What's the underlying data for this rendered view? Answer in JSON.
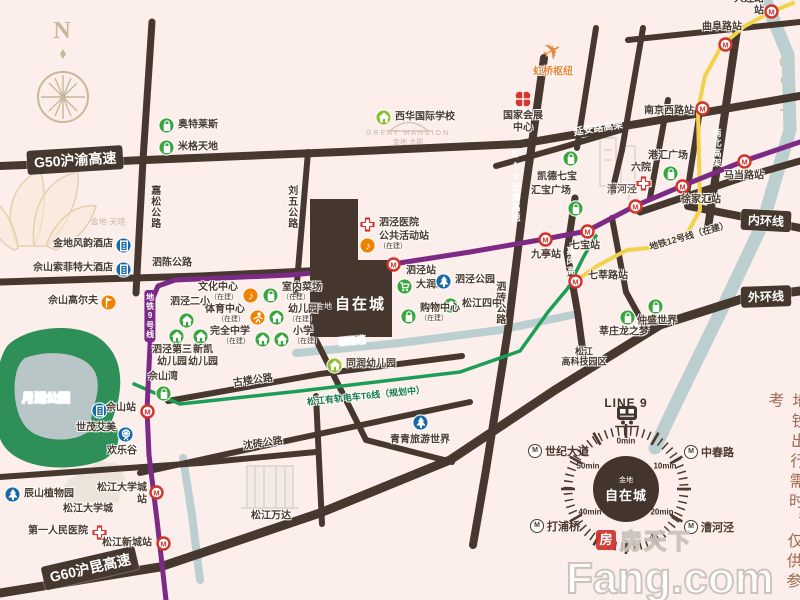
{
  "compass": {
    "letter": "N"
  },
  "colors": {
    "bg": "#fceeea",
    "road": "#46382f",
    "line9": "#7c2a85",
    "line12": "#f2d24b",
    "tram": "#1d9e57",
    "water": "#bccfd0",
    "park": "#2e9058",
    "lake": "#b9c6c8",
    "metro_red": "#d0342c",
    "poi_green": "#3aa43f",
    "poi_lime": "#8cbf2f",
    "poi_blue": "#1668a8",
    "poi_orange": "#ef8200",
    "hospital_red": "#d7342c"
  },
  "icons": {
    "metro_glyph": "M"
  },
  "project": {
    "brand": "金地",
    "name": "自在城"
  },
  "road_banners": [
    {
      "text": "G50沪渝高速",
      "x": 27,
      "y": 148,
      "rot": -3.5,
      "fs": 14
    },
    {
      "text": "G60沪昆高速",
      "x": 42,
      "y": 556,
      "rot": -13,
      "fs": 14
    },
    {
      "text": "内环线",
      "x": 741,
      "y": 210,
      "rot": 3,
      "fs": 12
    },
    {
      "text": "外环线",
      "x": 741,
      "y": 286,
      "rot": -2,
      "fs": 12
    }
  ],
  "onroad_labels": [
    {
      "text": "延安路高架",
      "x": 598,
      "y": 127,
      "rot": -9,
      "fs": 10
    },
    {
      "text": "G15沈海高速",
      "x": 516,
      "y": 186,
      "vertical": true,
      "fs": 9
    },
    {
      "text": "南北高架",
      "x": 717,
      "y": 148,
      "vertical": true,
      "fs": 9
    },
    {
      "text": "嘉闵高架",
      "x": 571,
      "y": 266,
      "vertical": true,
      "fs": 9
    }
  ],
  "street_labels": [
    {
      "text": "嘉松公路",
      "x": 154,
      "y": 207,
      "vertical": true,
      "fs": 10
    },
    {
      "text": "刘五公路",
      "x": 291,
      "y": 207,
      "vertical": true,
      "fs": 10
    },
    {
      "text": "泗陈公路",
      "x": 172,
      "y": 263,
      "fs": 10
    },
    {
      "text": "泗砖公路",
      "x": 499,
      "y": 303,
      "vertical": true,
      "fs": 10
    },
    {
      "text": "古楼公路",
      "x": 253,
      "y": 381,
      "rot": -8,
      "fs": 10
    },
    {
      "text": "沈砖公路",
      "x": 263,
      "y": 444,
      "rot": -8,
      "fs": 10
    }
  ],
  "area_labels": [
    {
      "text": "漕河泾",
      "x": 622,
      "y": 190,
      "fs": 10,
      "color": "#6b584a"
    },
    {
      "text": "松江\n高科技园区",
      "x": 584,
      "y": 357,
      "fs": 9
    },
    {
      "text": "松江大学城",
      "x": 88,
      "y": 509,
      "fs": 10
    },
    {
      "text": "松江万达",
      "x": 271,
      "y": 516,
      "fs": 10
    }
  ],
  "watermark_labels": [
    {
      "text": "金地·天境",
      "x": 108,
      "y": 222,
      "fs": 8
    },
    {
      "text": "GREAT MANSION",
      "x": 408,
      "y": 134,
      "fs": 7,
      "ls": 2
    },
    {
      "text": "金地·大郡",
      "x": 408,
      "y": 143,
      "fs": 7
    }
  ],
  "roads": [
    {
      "name": "G50-yanan-elevated",
      "pts": [
        [
          0,
          166
        ],
        [
          340,
          152
        ],
        [
          520,
          144
        ],
        [
          800,
          96
        ]
      ],
      "w": 8
    },
    {
      "name": "jiasong-rd",
      "pts": [
        [
          152,
          22
        ],
        [
          143,
          160
        ],
        [
          136,
          293
        ]
      ],
      "w": 7
    },
    {
      "name": "liuwu-rd",
      "pts": [
        [
          308,
          152
        ],
        [
          296,
          294
        ]
      ],
      "w": 6
    },
    {
      "name": "sichen-rd",
      "pts": [
        [
          0,
          282
        ],
        [
          200,
          276
        ],
        [
          350,
          269
        ]
      ],
      "w": 7
    },
    {
      "name": "g15-sizhuan-rd",
      "pts": [
        [
          544,
          58
        ],
        [
          524,
          200
        ],
        [
          508,
          330
        ],
        [
          486,
          470
        ],
        [
          473,
          545
        ]
      ],
      "w": 8
    },
    {
      "name": "jiamin-elevated",
      "pts": [
        [
          575,
          198
        ],
        [
          567,
          252
        ],
        [
          578,
          315
        ],
        [
          584,
          360
        ]
      ],
      "w": 7
    },
    {
      "name": "nanbei-elevated",
      "pts": [
        [
          737,
          30
        ],
        [
          721,
          140
        ],
        [
          708,
          228
        ]
      ],
      "w": 8
    },
    {
      "name": "inner-ring-rd",
      "pts": [
        [
          688,
          206
        ],
        [
          800,
          228
        ]
      ],
      "w": 8
    },
    {
      "name": "g60-outer-ring-rd",
      "pts": [
        [
          0,
          593
        ],
        [
          160,
          567
        ],
        [
          320,
          513
        ],
        [
          450,
          460
        ],
        [
          555,
          390
        ],
        [
          660,
          325
        ],
        [
          745,
          298
        ],
        [
          800,
          291
        ]
      ],
      "w": 9
    },
    {
      "name": "gulou-rd",
      "pts": [
        [
          168,
          401
        ],
        [
          320,
          374
        ],
        [
          462,
          356
        ]
      ],
      "w": 6
    },
    {
      "name": "shenzhuan-rd",
      "pts": [
        [
          140,
          473
        ],
        [
          300,
          438
        ],
        [
          470,
          402
        ]
      ],
      "w": 6
    },
    {
      "name": "wanda-rd",
      "pts": [
        [
          316,
          396
        ],
        [
          322,
          524
        ]
      ],
      "w": 6
    },
    {
      "name": "mid-diagonal-rd",
      "pts": [
        [
          316,
          340
        ],
        [
          366,
          440
        ],
        [
          452,
          462
        ]
      ],
      "w": 6
    },
    {
      "name": "songjiang-rd",
      "pts": [
        [
          0,
          477
        ],
        [
          200,
          463
        ],
        [
          316,
          452
        ]
      ],
      "w": 6
    },
    {
      "name": "hongqiao-rd-1",
      "pts": [
        [
          596,
          28
        ],
        [
          577,
          148
        ]
      ],
      "w": 6
    },
    {
      "name": "hongqiao-rd-2",
      "pts": [
        [
          643,
          28
        ],
        [
          622,
          150
        ],
        [
          612,
          192
        ]
      ],
      "w": 6
    },
    {
      "name": "qibao-rd",
      "pts": [
        [
          496,
          166
        ],
        [
          560,
          148
        ],
        [
          624,
          129
        ]
      ],
      "w": 6
    },
    {
      "name": "xujiahui-rd-1",
      "pts": [
        [
          668,
          100
        ],
        [
          650,
          198
        ]
      ],
      "w": 6
    },
    {
      "name": "xujiahui-rd-2",
      "pts": [
        [
          701,
          104
        ],
        [
          686,
          200
        ]
      ],
      "w": 6
    },
    {
      "name": "zhaojiabang-rd",
      "pts": [
        [
          640,
          212
        ],
        [
          744,
          177
        ],
        [
          800,
          161
        ]
      ],
      "w": 7
    },
    {
      "name": "north-bund-rd",
      "pts": [
        [
          628,
          40
        ],
        [
          800,
          22
        ]
      ],
      "w": 6
    },
    {
      "name": "xinzhuang-rd",
      "pts": [
        [
          612,
          218
        ],
        [
          626,
          292
        ],
        [
          648,
          332
        ]
      ],
      "w": 6
    }
  ],
  "transit": {
    "line9": {
      "color": "#7c2a85",
      "w": 5,
      "label": "地铁9号线",
      "label_x": 150,
      "label_y": 316,
      "path": [
        [
          166,
          600
        ],
        [
          157,
          520
        ],
        [
          149,
          455
        ],
        [
          147,
          410
        ],
        [
          150,
          345
        ],
        [
          152,
          300
        ],
        [
          158,
          286
        ],
        [
          175,
          280
        ],
        [
          290,
          275
        ],
        [
          345,
          270
        ],
        [
          393,
          264
        ],
        [
          470,
          252
        ],
        [
          545,
          239
        ],
        [
          587,
          231
        ],
        [
          635,
          206
        ],
        [
          682,
          186
        ],
        [
          744,
          161
        ],
        [
          800,
          142
        ]
      ]
    },
    "line12": {
      "color": "#f2d24b",
      "w": 4,
      "label": "地铁12号线（在建）",
      "label_x": 689,
      "label_y": 236,
      "label_rot": -16,
      "path": [
        [
          793,
          3
        ],
        [
          771,
          12
        ],
        [
          745,
          26
        ],
        [
          722,
          45
        ],
        [
          705,
          76
        ],
        [
          698,
          110
        ],
        [
          699,
          160
        ],
        [
          700,
          210
        ],
        [
          688,
          232
        ],
        [
          660,
          247
        ],
        [
          627,
          250
        ],
        [
          597,
          266
        ],
        [
          577,
          280
        ]
      ]
    },
    "tram": {
      "color": "#1d9e57",
      "w": 3.5,
      "label": "松江有轨电车T6线（规划中）",
      "label_x": 366,
      "label_y": 396,
      "label_rot": -6,
      "label_color": "#14794a",
      "path": [
        [
          134,
          384
        ],
        [
          180,
          404
        ],
        [
          300,
          391
        ],
        [
          460,
          372
        ],
        [
          520,
          351
        ],
        [
          548,
          312
        ],
        [
          568,
          288
        ],
        [
          584,
          256
        ],
        [
          596,
          236
        ]
      ]
    }
  },
  "stations": [
    {
      "name": "大连路站",
      "x": 771,
      "y": 11,
      "lx": 764,
      "ly": 5,
      "a": "r"
    },
    {
      "name": "曲阜路站",
      "x": 725,
      "y": 44,
      "lx": 722,
      "ly": 27,
      "a": "c"
    },
    {
      "name": "南京西路站",
      "x": 702,
      "y": 108,
      "lx": 694,
      "ly": 111,
      "a": "r"
    },
    {
      "name": "马当路站",
      "x": 744,
      "y": 161,
      "lx": 744,
      "ly": 176,
      "a": "c"
    },
    {
      "name": "徐家汇站",
      "x": 682,
      "y": 186,
      "lx": 701,
      "ly": 200,
      "a": "c"
    },
    {
      "name": "",
      "x": 635,
      "y": 206
    },
    {
      "name": "七宝站",
      "x": 587,
      "y": 231,
      "lx": 585,
      "ly": 246,
      "a": "c"
    },
    {
      "name": "九亭站",
      "x": 545,
      "y": 239,
      "lx": 546,
      "ly": 255,
      "a": "c"
    },
    {
      "name": "泗泾站",
      "x": 393,
      "y": 264,
      "lx": 406,
      "ly": 271,
      "a": "l"
    },
    {
      "name": "佘山站",
      "x": 147,
      "y": 411,
      "lx": 136,
      "ly": 408,
      "a": "r"
    },
    {
      "name": "松江大学城站",
      "x": 156,
      "y": 492,
      "lx": 147,
      "ly": 494,
      "a": "r",
      "w": 52
    },
    {
      "name": "松江新城站",
      "x": 163,
      "y": 543,
      "lx": 152,
      "ly": 543,
      "a": "r"
    },
    {
      "name": "七莘路站",
      "x": 575,
      "y": 281,
      "lx": 588,
      "ly": 276,
      "a": "l"
    }
  ],
  "pois": [
    {
      "t": "bag",
      "c": "green",
      "x": 166,
      "y": 125,
      "label": "奥特莱斯",
      "lx": 178,
      "ly": 125,
      "a": "l"
    },
    {
      "t": "bag",
      "c": "green",
      "x": 166,
      "y": 147,
      "label": "米格天地",
      "lx": 178,
      "ly": 147,
      "a": "l"
    },
    {
      "t": "home",
      "c": "lime",
      "x": 383,
      "y": 117,
      "label": "西华国际学校",
      "lx": 395,
      "ly": 117,
      "a": "l"
    },
    {
      "t": "clover",
      "c": "red",
      "x": 523,
      "y": 99,
      "label": "国家会展\n中心",
      "lx": 523,
      "ly": 122,
      "a": "c"
    },
    {
      "t": "plane",
      "c": "orange",
      "x": 552,
      "y": 51,
      "label": "虹桥枢纽",
      "lx": 553,
      "ly": 72,
      "a": "c",
      "lc": "#e8873b"
    },
    {
      "t": "bag",
      "c": "green",
      "x": 570,
      "y": 158,
      "label": "凯德七宝",
      "lx": 557,
      "ly": 177,
      "a": "c"
    },
    {
      "t": "bag",
      "c": "green",
      "x": 575,
      "y": 208,
      "label": "汇宝广场",
      "lx": 551,
      "ly": 191,
      "a": "c"
    },
    {
      "t": "cross",
      "c": "red",
      "x": 643,
      "y": 183,
      "label": "六院",
      "lx": 641,
      "ly": 168,
      "a": "c"
    },
    {
      "t": "bag",
      "c": "green",
      "x": 670,
      "y": 173,
      "label": "港汇广场",
      "lx": 668,
      "ly": 156,
      "a": "c"
    },
    {
      "t": "cart",
      "c": "green",
      "x": 404,
      "y": 286,
      "label": "大润发",
      "lx": 416,
      "ly": 285,
      "a": "l"
    },
    {
      "t": "tree",
      "c": "blue",
      "x": 443,
      "y": 281,
      "label": "泗泾公园",
      "lx": 455,
      "ly": 280,
      "a": "l"
    },
    {
      "t": "home",
      "c": "green",
      "x": 450,
      "y": 305,
      "label": "松江四中",
      "lx": 462,
      "ly": 304,
      "a": "l"
    },
    {
      "t": "bag",
      "c": "green",
      "x": 408,
      "y": 316,
      "label": "购物中心",
      "sub": "（在建）",
      "lx": 420,
      "ly": 313,
      "a": "l"
    },
    {
      "t": "cross",
      "c": "red",
      "x": 367,
      "y": 224,
      "label": "泗泾医院",
      "lx": 379,
      "ly": 223,
      "a": "l"
    },
    {
      "t": "music",
      "c": "orange",
      "x": 367,
      "y": 245,
      "label": "公共活动站",
      "sub": "（在建）",
      "lx": 379,
      "ly": 241,
      "a": "l"
    },
    {
      "t": "music",
      "c": "orange",
      "x": 250,
      "y": 295,
      "label": "文化中心",
      "sub": "（在建）",
      "lx": 238,
      "ly": 292,
      "a": "r"
    },
    {
      "t": "bag",
      "c": "green",
      "x": 270,
      "y": 295,
      "label": "室内菜场",
      "sub": "（在建）",
      "lx": 282,
      "ly": 292,
      "a": "l"
    },
    {
      "t": "sport",
      "c": "orange",
      "x": 257,
      "y": 317,
      "label": "体育中心",
      "sub": "（在建）",
      "lx": 245,
      "ly": 314,
      "a": "r"
    },
    {
      "t": "home",
      "c": "green",
      "x": 276,
      "y": 317,
      "label": "幼儿园",
      "sub": "（在建）",
      "lx": 288,
      "ly": 314,
      "a": "l"
    },
    {
      "t": "home",
      "c": "green",
      "x": 262,
      "y": 339,
      "label": "完全中学",
      "sub": "（在建）",
      "lx": 250,
      "ly": 336,
      "a": "r"
    },
    {
      "t": "home",
      "c": "green",
      "x": 281,
      "y": 339,
      "label": "小学",
      "sub": "（在建）",
      "lx": 293,
      "ly": 336,
      "a": "l"
    },
    {
      "t": "home",
      "c": "green",
      "x": 186,
      "y": 320,
      "label": "泗泾二小",
      "lx": 190,
      "ly": 302,
      "a": "c"
    },
    {
      "t": "home",
      "c": "green",
      "x": 176,
      "y": 336,
      "label": "泗泾第三\n幼儿园",
      "lx": 172,
      "ly": 356,
      "a": "c"
    },
    {
      "t": "home",
      "c": "green",
      "x": 200,
      "y": 336,
      "label": "新凯\n幼儿园",
      "lx": 203,
      "ly": 356,
      "a": "c"
    },
    {
      "t": "bag",
      "c": "green",
      "x": 163,
      "y": 393,
      "label": "佘山湾",
      "lx": 163,
      "ly": 377,
      "a": "c"
    },
    {
      "t": "flag",
      "c": "orange",
      "x": 108,
      "y": 302,
      "label": "佘山高尔夫",
      "lx": 98,
      "ly": 301,
      "a": "r"
    },
    {
      "t": "building",
      "c": "blue",
      "x": 123,
      "y": 245,
      "label": "金地风韵酒店",
      "lx": 113,
      "ly": 244,
      "a": "r"
    },
    {
      "t": "building",
      "c": "blue",
      "x": 123,
      "y": 269,
      "label": "佘山索菲特大酒店",
      "lx": 113,
      "ly": 268,
      "a": "r"
    },
    {
      "t": "building",
      "c": "blue",
      "x": 99,
      "y": 410,
      "label": "世茂艾美",
      "lx": 96,
      "ly": 428,
      "a": "c"
    },
    {
      "t": "ferris",
      "c": "blue",
      "x": 125,
      "y": 434,
      "label": "欢乐谷",
      "lx": 122,
      "ly": 451,
      "a": "c"
    },
    {
      "t": "tree",
      "c": "blue",
      "x": 12,
      "y": 494,
      "label": "辰山植物园",
      "lx": 24,
      "ly": 494,
      "a": "l"
    },
    {
      "t": "cross",
      "c": "red",
      "x": 99,
      "y": 532,
      "label": "第一人民医院",
      "lx": 88,
      "ly": 531,
      "a": "r"
    },
    {
      "t": "home",
      "c": "lime",
      "x": 334,
      "y": 365,
      "label": "同润幼儿园",
      "lx": 346,
      "ly": 364,
      "a": "l"
    },
    {
      "t": "tree",
      "c": "blue",
      "x": 420,
      "y": 422,
      "label": "青青旅游世界",
      "lx": 420,
      "ly": 440,
      "a": "c"
    },
    {
      "t": "bag",
      "c": "green",
      "x": 655,
      "y": 306,
      "label": "仲盛世界",
      "lx": 657,
      "ly": 321,
      "a": "c"
    },
    {
      "t": "bag",
      "c": "green",
      "x": 627,
      "y": 317,
      "label": "莘庄龙之梦",
      "lx": 624,
      "ly": 332,
      "a": "c"
    }
  ],
  "water": {
    "paths": [
      {
        "name": "huangpu-river",
        "pts": [
          [
            762,
            -8
          ],
          [
            788,
            55
          ],
          [
            790,
            130
          ],
          [
            762,
            225
          ],
          [
            724,
            305
          ],
          [
            697,
            360
          ],
          [
            668,
            420
          ],
          [
            655,
            448
          ]
        ],
        "w": 13
      },
      {
        "name": "sijing-creek",
        "pts": [
          [
            296,
            353
          ],
          [
            400,
            343
          ],
          [
            500,
            330
          ],
          [
            572,
            315
          ]
        ],
        "w": 8
      },
      {
        "name": "youdun-creek",
        "pts": [
          [
            183,
            458
          ],
          [
            192,
            515
          ],
          [
            200,
            580
          ]
        ],
        "w": 8
      }
    ],
    "label": {
      "text": "泗泾塘",
      "x": 352,
      "y": 341,
      "rot": -5
    }
  },
  "park": {
    "label": {
      "text": "月湖公园"
    }
  },
  "clock": {
    "title": "LINE 9",
    "brand": "金地",
    "name": "自在城",
    "ticks": [
      {
        "text": "0min",
        "x": 626,
        "y": 441
      },
      {
        "text": "10min",
        "x": 665,
        "y": 466
      },
      {
        "text": "20min",
        "x": 662,
        "y": 512
      },
      {
        "text": "40min",
        "x": 590,
        "y": 512
      },
      {
        "text": "50min",
        "x": 588,
        "y": 466
      }
    ],
    "stations": [
      {
        "name": "世纪大道",
        "x": 528,
        "y": 451
      },
      {
        "name": "中春路",
        "x": 684,
        "y": 452
      },
      {
        "name": "打浦桥",
        "x": 530,
        "y": 526
      },
      {
        "name": "漕河泾",
        "x": 684,
        "y": 527
      }
    ]
  },
  "note": {
    "text": "地铁出行需时，仅供参考"
  },
  "fang": {
    "logo_char": "房",
    "cn": "房天下",
    "en": "Fang.com"
  }
}
